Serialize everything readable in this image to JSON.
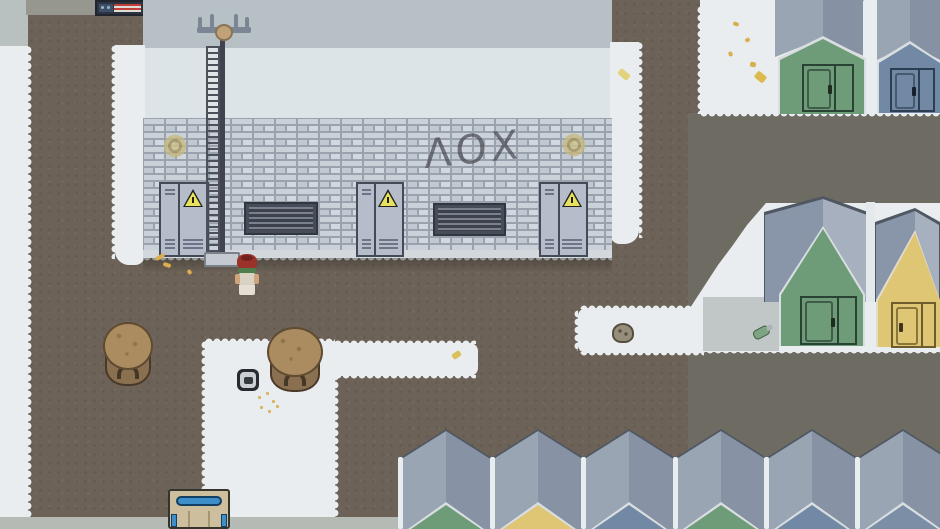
{
  "scene": {
    "type": "top-down pixel-art game scene",
    "setting": "winter refugee camp with utility building, radio tower and tents",
    "graffiti_text": "ΛΟΧ",
    "palette": {
      "dirt": "#6c6257",
      "dirt_gray_east": "#6e6b62",
      "snow": "#e9edf0",
      "pavement": "#b5bab5",
      "building_roof_top": "#b7c0c4",
      "building_roof_main": "#dce4e7",
      "brick": "#c9d0d9",
      "mortar": "#9aa2ae",
      "metal_door": "#b6bdca",
      "door_outline": "#454a57",
      "hazard_yellow": "#e9e25b",
      "tent_roof_light": "#9aa5b3",
      "tent_roof_dark": "#8692a3",
      "tent_green": "#6f9c78",
      "tent_yellow": "#dfc674",
      "tent_blue": "#7189a4",
      "wood_spool": "#ab8c60",
      "crate_blue": "#3e8fc9",
      "character_cap": "#9c332a",
      "character_scarf": "#4f7d4c",
      "leaf_yellow": "#d9ae4e"
    },
    "objects": [
      "radio-tower-with-ladder",
      "brick-utility-building",
      "three-metal-doors-with-hazard-signs",
      "two-wall-vents",
      "wall-graffiti",
      "two-faded-wall-emblems",
      "player-character-red-cap",
      "two-wooden-spool-tables",
      "camp-stove",
      "supply-crate-blue-trim",
      "rock-on-snow-path",
      "green-bottle-on-snow",
      "striped-banner-sign",
      "green-tent",
      "blue-tent",
      "yellow-tent",
      "row-of-six-gray-tent-roofs"
    ],
    "bottom_tent_gable_colors": [
      "green",
      "yellow",
      "blue",
      "green",
      "blue",
      "blue"
    ]
  }
}
